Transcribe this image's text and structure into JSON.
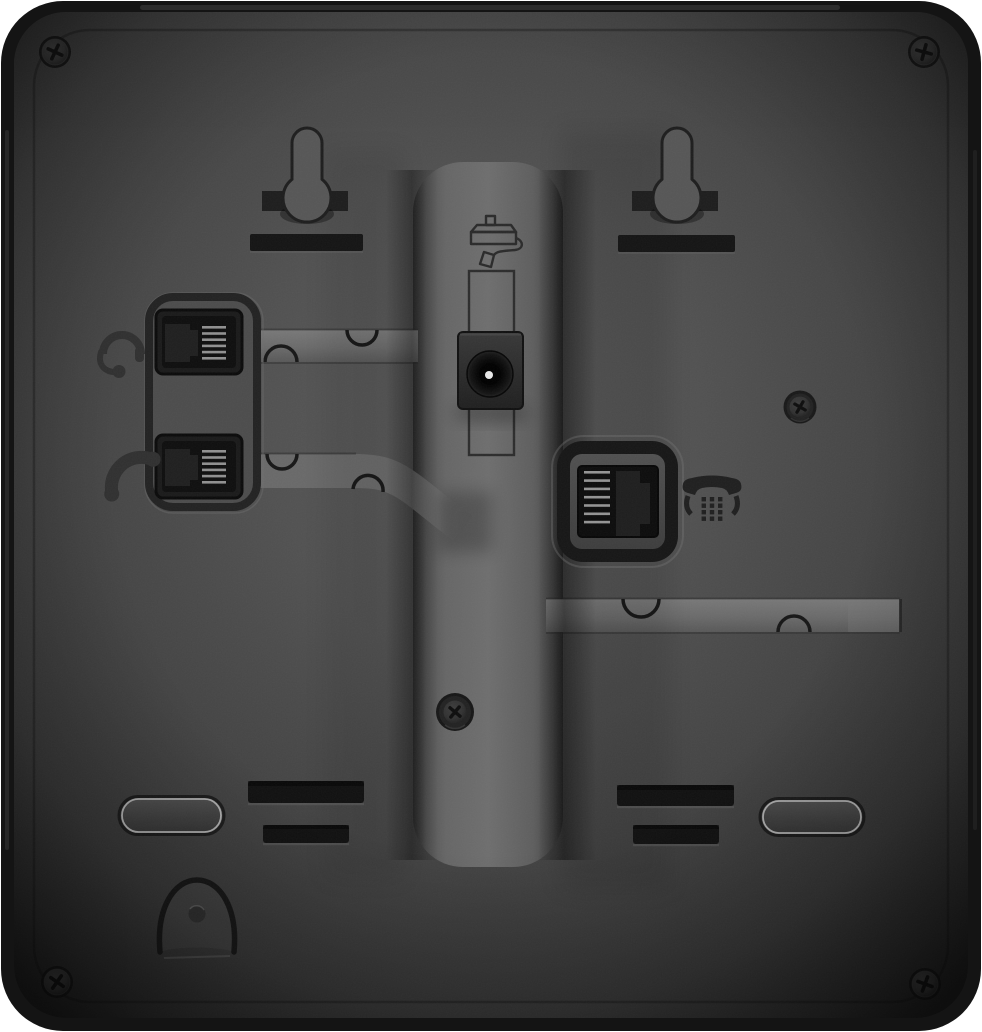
{
  "scene": {
    "description": "Rear view photograph of a black desk telephone chassis",
    "page_background": "#ffffff"
  },
  "colors": {
    "chassis_edge": "#151515",
    "panel_center": "#5a5a5a",
    "panel_shadow": "#1d1d1d",
    "channel": "#6e6e6e",
    "slot": "#111111",
    "contact_stripes": "#949494",
    "dc_pin_highlight": "#e8e8e8",
    "engraving": "#2a2a2a"
  },
  "ports": {
    "headset": {
      "icon": "headset-icon",
      "label": "headset jack"
    },
    "handset": {
      "icon": "handset-icon",
      "label": "handset jack"
    },
    "power": {
      "icon": "power-adapter-icon",
      "label": "DC power jack"
    },
    "line": {
      "icon": "desk-phone-icon",
      "label": "phone line jack"
    }
  },
  "mounting": {
    "keyhole_slots": 2,
    "corner_screws": 4,
    "panel_screws": 2
  },
  "features": {
    "cable_channels": 3,
    "vent_slots": 4,
    "feet": 2,
    "hook_recess": 1
  }
}
